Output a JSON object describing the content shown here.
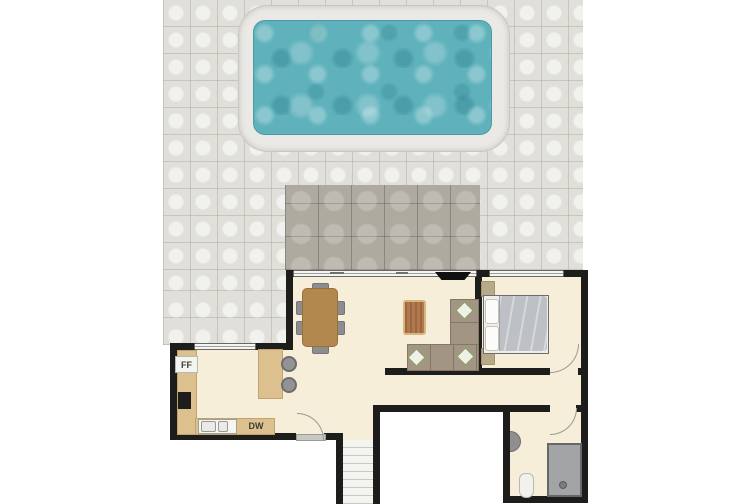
{
  "scene": {
    "type": "floor-plan",
    "rooms": [
      "patio",
      "swimming-pool",
      "dark-paved-terrace",
      "living-dining-room",
      "kitchen",
      "bedroom",
      "hallway",
      "bathroom",
      "staircase"
    ]
  },
  "labels": {
    "fridge_freezer": "FF",
    "dishwasher": "DW"
  },
  "colors": {
    "background": "#ffffff",
    "wall": "#1d1d1b",
    "floor_cream": "#f7eed9",
    "patio_light": "#e1dfda",
    "patio_dark": "#aeaaa0",
    "pool_water": "#5fb2bc",
    "pool_coping": "#eae9e5",
    "counter_tan": "#dcc18f",
    "dining_table_brown": "#b2884e",
    "chair_gray": "#8d8d8f",
    "sofa_taupe": "#a29584",
    "pillow_green": "#7f9b50",
    "bed_duvet_gray": "#bdc1c5",
    "shower_gray": "#a3a4a6"
  }
}
